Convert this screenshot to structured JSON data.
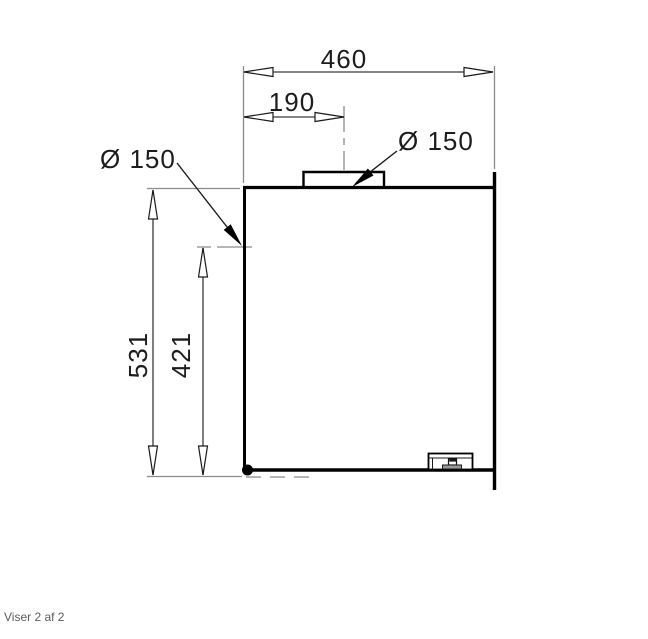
{
  "footer": {
    "label": "Viser 2 af 2"
  },
  "drawing": {
    "description": "technical-dimension-drawing-of-hood-with-top-spigot",
    "labels": {
      "width_total": "460",
      "spigot_center_offset": "190",
      "top_spigot_diameter": "Ø 150",
      "side_spigot_diameter": "Ø 150",
      "height_total": "531",
      "side_spigot_height": "421"
    },
    "colors": {
      "outline": "#000000",
      "dimension_line": "#3a3a3a",
      "extension_line": "#8a8a8a",
      "label_text": "#1c1c1c",
      "footer_text": "#5a5a5a"
    }
  }
}
